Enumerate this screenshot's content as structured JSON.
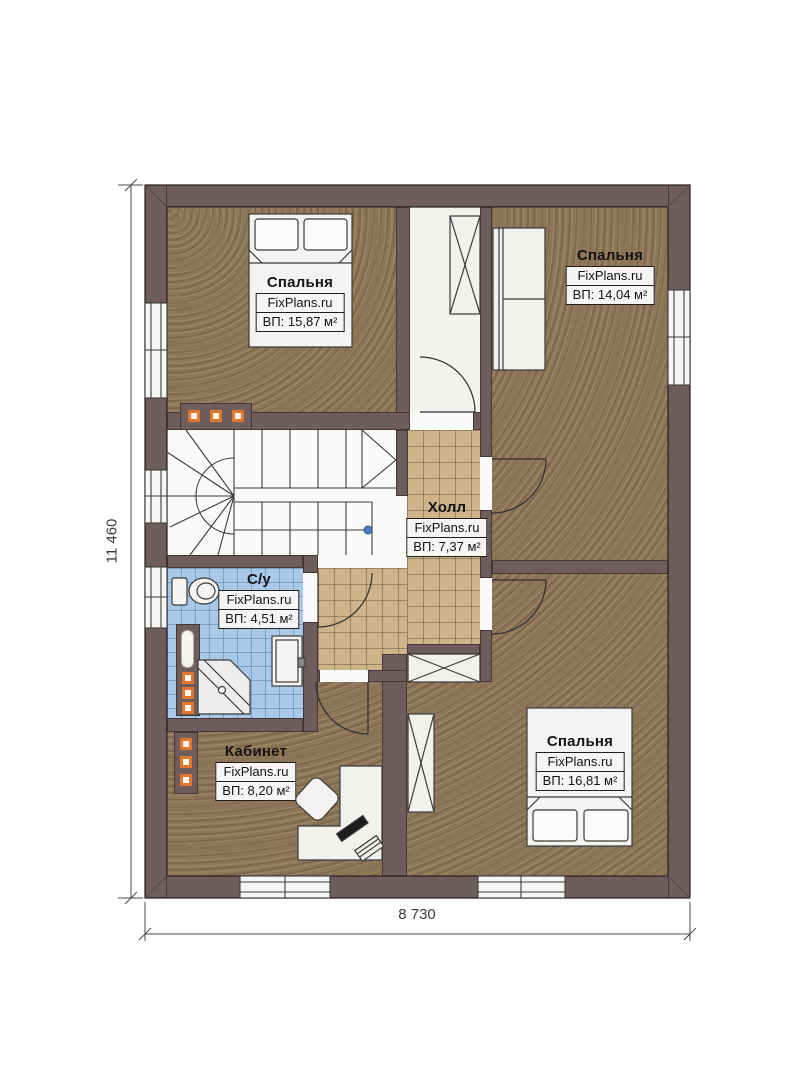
{
  "title": "Floor plan with room areas",
  "watermark": "FixPlans.ru",
  "dimensions": {
    "height_label": "11 460",
    "width_label": "8 730"
  },
  "rooms": [
    {
      "id": "bedroom-top-left",
      "name": "Спальня",
      "brand": "FixPlans.ru",
      "area": "ВП: 15,87 м²"
    },
    {
      "id": "bedroom-top-right",
      "name": "Спальня",
      "brand": "FixPlans.ru",
      "area": "ВП: 14,04 м²"
    },
    {
      "id": "hall",
      "name": "Холл",
      "brand": "FixPlans.ru",
      "area": "ВП: 7,37 м²"
    },
    {
      "id": "bathroom",
      "name": "С/у",
      "brand": "FixPlans.ru",
      "area": "ВП: 4,51 м²"
    },
    {
      "id": "office",
      "name": "Кабинет",
      "brand": "FixPlans.ru",
      "area": "ВП: 8,20 м²"
    },
    {
      "id": "bedroom-bottom-right",
      "name": "Спальня",
      "brand": "FixPlans.ru",
      "area": "ВП: 16,81 м²"
    }
  ],
  "colors": {
    "wall": "#6f5c5d",
    "floor_brown": "#8d7558",
    "tile_beige": "#cdb48a",
    "tile_blue": "#a9c9e9",
    "accent_orange": "#e2762d",
    "stair_dot_blue": "#4a7fc1"
  }
}
